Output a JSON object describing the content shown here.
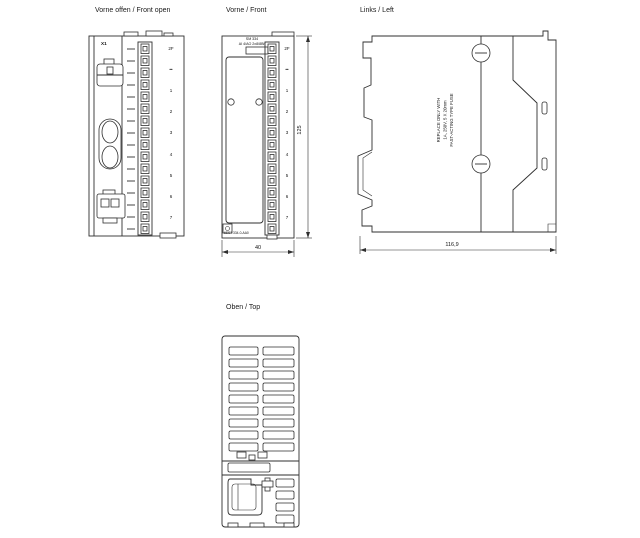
{
  "canvas": {
    "background": "#ffffff",
    "line_color": "#2f2f2f",
    "text_color": "#111111"
  },
  "views": {
    "front_open": {
      "label": "Vorne offen / Front open",
      "connector_label": "X1",
      "terminal_labels": [
        "2F",
        "••",
        "1",
        "2",
        "3",
        "4",
        "5",
        "6",
        "7"
      ]
    },
    "front": {
      "label": "Vorne / Front",
      "module_text_line1": "SM 334",
      "module_text_line2": "AI 4/AO 2x8/8Bit",
      "order_number": "6ES7 334-0-AA0",
      "terminal_labels": [
        "2F",
        "••",
        "1",
        "2",
        "3",
        "4",
        "5",
        "6",
        "7"
      ],
      "width_dim": "40",
      "height_dim": "125"
    },
    "left": {
      "label": "Links / Left",
      "fuse_note": [
        "REPLACE ONLY WITH",
        "1A, 250V, 5 X 20mm",
        "FAST-ACTING TYPE FUSE"
      ],
      "depth_dim": "116,9"
    },
    "top": {
      "label": "Oben / Top"
    }
  }
}
